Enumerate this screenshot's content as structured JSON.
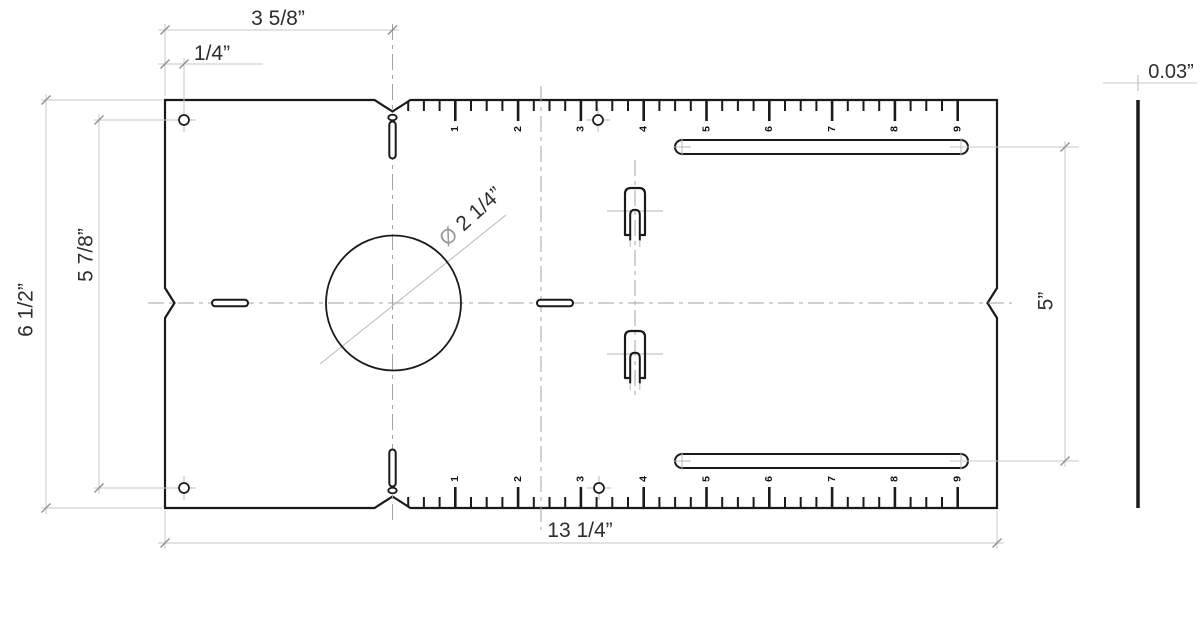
{
  "drawing": {
    "type": "mechanical-template-plate-drawing",
    "dimensions": {
      "ruler_zero_offset": "3 5/8”",
      "corner_hole_offset": "1/4”",
      "plate_height": "6 1/2”",
      "corner_hole_span": "5 7/8”",
      "plate_width": "13 1/4”",
      "slot_vertical_span": "5”",
      "plate_thickness": "0.03”",
      "center_hole_diameter_symbol": "Ø",
      "center_hole_diameter": "2 1/4”"
    },
    "ruler_numbers": [
      "1",
      "2",
      "3",
      "4",
      "5",
      "6",
      "7",
      "8",
      "9"
    ],
    "colors": {
      "outline": "#1a1a1a",
      "dimension_line": "#c7c7c7",
      "dimension_tick": "#8c8c8c",
      "centerline": "#a3a3a3",
      "crosshair": "#b8b8b8",
      "dimension_text": "#2e2e2e",
      "diameter_symbol": "#9a9a9a",
      "background": "#ffffff"
    }
  }
}
